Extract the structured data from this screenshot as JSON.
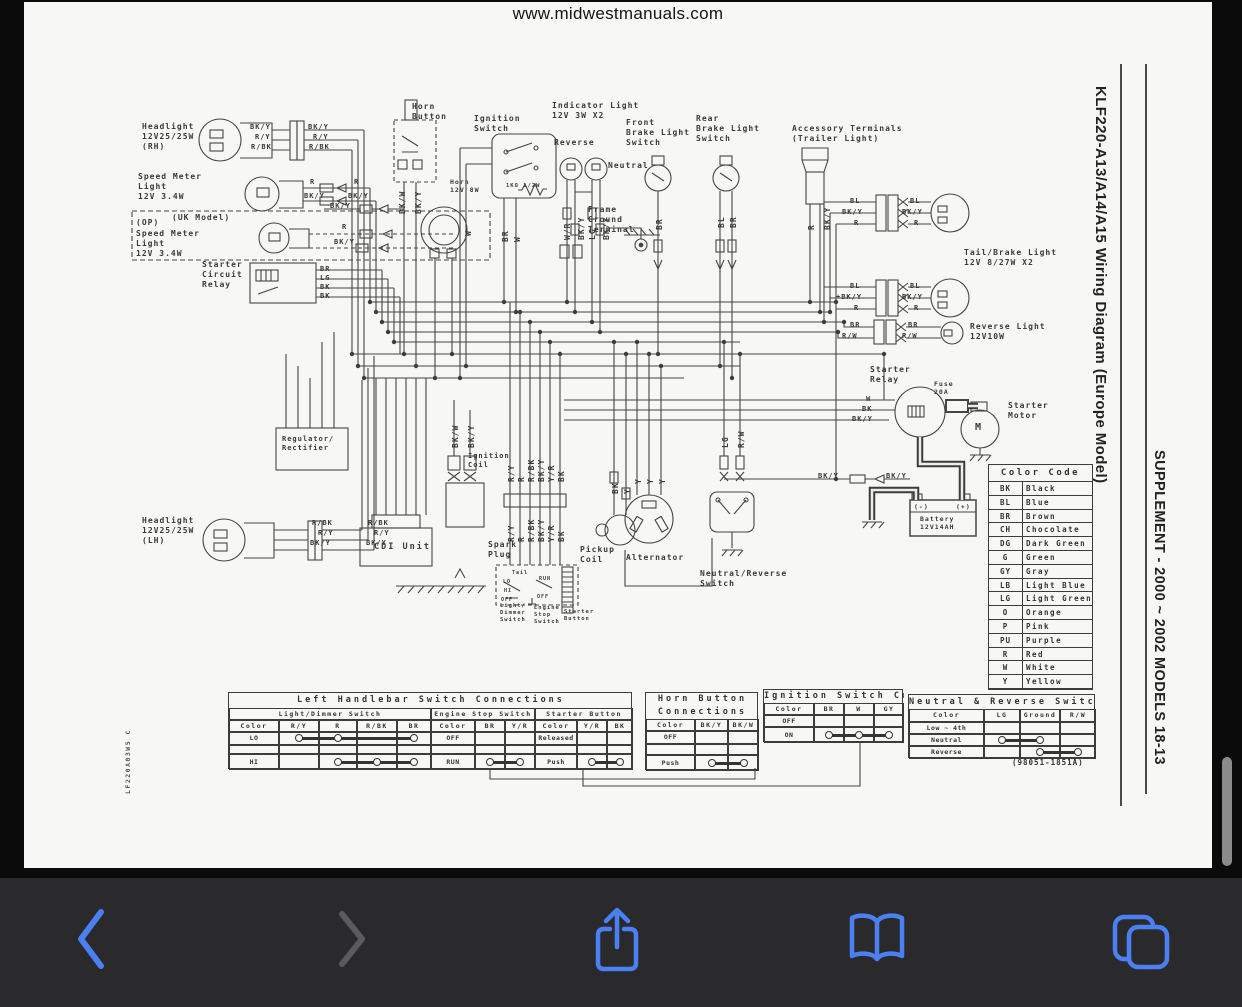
{
  "browser": {
    "url_header": "www.midwestmanuals.com",
    "toolbar": {
      "background": "#2a2a2c",
      "accent_blue": "#4b80f5",
      "disabled_gray": "#5b5b5f",
      "buttons": [
        {
          "name": "back",
          "enabled": true
        },
        {
          "name": "forward",
          "enabled": false
        },
        {
          "name": "share",
          "enabled": true
        },
        {
          "name": "bookmarks",
          "enabled": true
        },
        {
          "name": "tabs",
          "enabled": true
        }
      ]
    }
  },
  "page": {
    "side_title": "KLF220-A13/A14/A15 Wiring Diagram (Europe Model)",
    "side_subtitle": "SUPPLEMENT - 2000 ~ 2002 MODELS 18-13",
    "doc_code": "LF220A03W5 C",
    "part_number": "(98051-1851A)"
  },
  "color_code": {
    "title": "Color Code",
    "rows": [
      [
        "BK",
        "Black"
      ],
      [
        "BL",
        "Blue"
      ],
      [
        "BR",
        "Brown"
      ],
      [
        "CH",
        "Chocolate"
      ],
      [
        "DG",
        "Dark Green"
      ],
      [
        "G",
        "Green"
      ],
      [
        "GY",
        "Gray"
      ],
      [
        "LB",
        "Light Blue"
      ],
      [
        "LG",
        "Light Green"
      ],
      [
        "O",
        "Orange"
      ],
      [
        "P",
        "Pink"
      ],
      [
        "PU",
        "Purple"
      ],
      [
        "R",
        "Red"
      ],
      [
        "W",
        "White"
      ],
      [
        "Y",
        "Yellow"
      ]
    ]
  },
  "connection_tables": [
    {
      "x": 204,
      "y": 690,
      "w": 404,
      "title_lines": [
        "Left Handlebar Switch Connections"
      ],
      "title_h": 15,
      "sec_h": 12,
      "col_h": 12,
      "rows_h": [
        13,
        9,
        16
      ],
      "sections": [
        {
          "w": 202,
          "header": "Light/Dimmer Switch",
          "widths": [
            50,
            40,
            38,
            40,
            34
          ],
          "cols": [
            "Color",
            "R/Y",
            "R",
            "R/BK",
            "BR"
          ],
          "rows": [
            {
              "label": "LO",
              "conn": [
                1,
                2,
                4
              ]
            },
            {
              "label": ""
            },
            {
              "label": "HI",
              "conn": [
                2,
                3,
                4
              ]
            }
          ]
        },
        {
          "w": 104,
          "header": "Engine Stop Switch",
          "widths": [
            44,
            30,
            30
          ],
          "cols": [
            "Color",
            "BR",
            "Y/R"
          ],
          "rows": [
            {
              "label": "OFF"
            },
            {
              "label": ""
            },
            {
              "label": "RUN",
              "conn": [
                1,
                2
              ]
            }
          ]
        },
        {
          "w": 98,
          "header": "Starter Button",
          "widths": [
            42,
            30,
            26
          ],
          "cols": [
            "Color",
            "Y/R",
            "BK"
          ],
          "rows": [
            {
              "label": "Released"
            },
            {
              "label": ""
            },
            {
              "label": "Push",
              "conn": [
                1,
                2
              ]
            }
          ]
        }
      ]
    },
    {
      "x": 621,
      "y": 690,
      "w": 113,
      "title_lines": [
        "Horn Button",
        "Connections"
      ],
      "title_h": 26,
      "sec_h": 0,
      "col_h": 12,
      "rows_h": [
        13,
        11,
        16
      ],
      "sections": [
        {
          "w": 113,
          "header": null,
          "widths": [
            49,
            33,
            31
          ],
          "cols": [
            "Color",
            "BK/Y",
            "BK/W"
          ],
          "rows": [
            {
              "label": "OFF"
            },
            {
              "label": ""
            },
            {
              "label": "Push",
              "conn": [
                1,
                2
              ]
            }
          ]
        }
      ]
    },
    {
      "x": 739,
      "y": 687,
      "w": 140,
      "title_lines": [
        "Ignition Switch Connections"
      ],
      "title_h": 13,
      "sec_h": 0,
      "col_h": 12,
      "rows_h": [
        12,
        16
      ],
      "sections": [
        {
          "w": 140,
          "header": null,
          "widths": [
            50,
            30,
            30,
            30
          ],
          "cols": [
            "Color",
            "BR",
            "W",
            "GY"
          ],
          "rows": [
            {
              "label": "OFF"
            },
            {
              "label": "ON",
              "conn": [
                1,
                2,
                3
              ]
            }
          ]
        }
      ]
    },
    {
      "x": 884,
      "y": 692,
      "w": 187,
      "title_lines": [
        "Neutral & Reverse Switch Connections"
      ],
      "title_h": 14,
      "sec_h": 0,
      "col_h": 13,
      "rows_h": [
        12,
        12,
        13
      ],
      "sections": [
        {
          "w": 187,
          "header": null,
          "widths": [
            75,
            36,
            40,
            36
          ],
          "cols": [
            "Color",
            "LG",
            "Ground",
            "R/W"
          ],
          "rows": [
            {
              "label": "Low ~ 4th"
            },
            {
              "label": "Neutral",
              "conn": [
                1,
                2
              ]
            },
            {
              "label": "Reverse",
              "conn": [
                2,
                3
              ]
            }
          ]
        }
      ]
    }
  ],
  "diagram": {
    "labels": [
      {
        "x": 118,
        "y": 120,
        "t": "Headlight\n12V25/25W\n(RH)"
      },
      {
        "x": 226,
        "y": 121,
        "t": "BK/Y",
        "s": 7
      },
      {
        "x": 231,
        "y": 131,
        "t": "R/Y",
        "s": 7
      },
      {
        "x": 227,
        "y": 141,
        "t": "R/BK",
        "s": 7
      },
      {
        "x": 284,
        "y": 121,
        "t": "BK/Y",
        "s": 7
      },
      {
        "x": 289,
        "y": 131,
        "t": "R/Y",
        "s": 7
      },
      {
        "x": 285,
        "y": 141,
        "t": "R/BK",
        "s": 7
      },
      {
        "x": 114,
        "y": 170,
        "t": "Speed Meter\nLight\n12V 3.4W"
      },
      {
        "x": 286,
        "y": 176,
        "t": "R",
        "s": 7
      },
      {
        "x": 330,
        "y": 176,
        "t": "R",
        "s": 7
      },
      {
        "x": 280,
        "y": 190,
        "t": "BK/Y",
        "s": 7
      },
      {
        "x": 324,
        "y": 190,
        "t": "BK/Y",
        "s": 7
      },
      {
        "x": 306,
        "y": 200,
        "t": "BK/Y",
        "s": 7
      },
      {
        "x": 112,
        "y": 216,
        "t": "(OP)"
      },
      {
        "x": 148,
        "y": 211,
        "t": "(UK Model)"
      },
      {
        "x": 112,
        "y": 227,
        "t": "Speed Meter\nLight\n12V 3.4W"
      },
      {
        "x": 318,
        "y": 221,
        "t": "R",
        "s": 7
      },
      {
        "x": 310,
        "y": 236,
        "t": "BK/Y",
        "s": 7
      },
      {
        "x": 178,
        "y": 258,
        "t": "Starter\nCircuit\nRelay"
      },
      {
        "x": 296,
        "y": 263,
        "t": "BR",
        "s": 7
      },
      {
        "x": 296,
        "y": 272,
        "t": "LG",
        "s": 7
      },
      {
        "x": 296,
        "y": 281,
        "t": "BK",
        "s": 7
      },
      {
        "x": 296,
        "y": 290,
        "t": "BK",
        "s": 7
      },
      {
        "x": 388,
        "y": 100,
        "t": "Horn\nButton"
      },
      {
        "x": 450,
        "y": 112,
        "t": "Ignition\nSwitch"
      },
      {
        "x": 426,
        "y": 176,
        "t": "Horn\n12V 8W",
        "s": 6.5
      },
      {
        "x": 482,
        "y": 181,
        "t": "1KΩ 1/2W",
        "s": 5.5
      },
      {
        "x": 528,
        "y": 99,
        "t": "Indicator Light\n12V 3W X2"
      },
      {
        "x": 530,
        "y": 136,
        "t": "Reverse"
      },
      {
        "x": 584,
        "y": 159,
        "t": "Neutral"
      },
      {
        "x": 564,
        "y": 203,
        "t": "Frame\nGround\nTerminal"
      },
      {
        "x": 602,
        "y": 116,
        "t": "Front\nBrake Light\nSwitch"
      },
      {
        "x": 672,
        "y": 112,
        "t": "Rear\nBrake Light\nSwitch"
      },
      {
        "x": 768,
        "y": 122,
        "t": "Accessory Terminals\n(Trailer Light)"
      },
      {
        "x": 940,
        "y": 246,
        "t": "Tail/Brake Light\n12V 8/27W X2"
      },
      {
        "x": 826,
        "y": 195,
        "t": "BL",
        "s": 7
      },
      {
        "x": 818,
        "y": 206,
        "t": "BK/Y",
        "s": 7
      },
      {
        "x": 830,
        "y": 217,
        "t": "R",
        "s": 7
      },
      {
        "x": 886,
        "y": 195,
        "t": "BL",
        "s": 7
      },
      {
        "x": 878,
        "y": 206,
        "t": "BK/Y",
        "s": 7
      },
      {
        "x": 890,
        "y": 217,
        "t": "R",
        "s": 7
      },
      {
        "x": 826,
        "y": 280,
        "t": "BL",
        "s": 7
      },
      {
        "x": 812,
        "y": 291,
        "t": "+BK/Y",
        "s": 7
      },
      {
        "x": 830,
        "y": 302,
        "t": "R",
        "s": 7
      },
      {
        "x": 886,
        "y": 280,
        "t": "BL",
        "s": 7
      },
      {
        "x": 878,
        "y": 291,
        "t": "BK/Y",
        "s": 7
      },
      {
        "x": 890,
        "y": 302,
        "t": "R",
        "s": 7
      },
      {
        "x": 826,
        "y": 319,
        "t": "BR",
        "s": 7
      },
      {
        "x": 818,
        "y": 330,
        "t": "R/W",
        "s": 7
      },
      {
        "x": 884,
        "y": 319,
        "t": "BR",
        "s": 7
      },
      {
        "x": 878,
        "y": 330,
        "t": "R/W",
        "s": 7
      },
      {
        "x": 946,
        "y": 320,
        "t": "Reverse Light\n12V10W"
      },
      {
        "x": 846,
        "y": 363,
        "t": "Starter\nRelay"
      },
      {
        "x": 910,
        "y": 378,
        "t": "Fuse\n20A",
        "s": 6.5
      },
      {
        "x": 984,
        "y": 399,
        "t": "Starter\nMotor"
      },
      {
        "x": 842,
        "y": 393,
        "t": "W",
        "s": 7
      },
      {
        "x": 838,
        "y": 403,
        "t": "BK",
        "s": 7
      },
      {
        "x": 828,
        "y": 413,
        "t": "BK/Y",
        "s": 7
      },
      {
        "x": 794,
        "y": 470,
        "t": "BK/Y",
        "s": 7
      },
      {
        "x": 862,
        "y": 470,
        "t": "BK/Y",
        "s": 7
      },
      {
        "x": 890,
        "y": 501,
        "t": "(-)",
        "s": 6.5
      },
      {
        "x": 932,
        "y": 501,
        "t": "(+)",
        "s": 6.5
      },
      {
        "x": 896,
        "y": 513,
        "t": "Battery\n12V14AH",
        "s": 6.5
      },
      {
        "x": 258,
        "y": 433,
        "t": "Regulator/\nRectifier",
        "s": 7
      },
      {
        "x": 118,
        "y": 514,
        "t": "Headlight\n12V25/25W\n(LH)"
      },
      {
        "x": 288,
        "y": 517,
        "t": "R/BK",
        "s": 7
      },
      {
        "x": 294,
        "y": 527,
        "t": "R/Y",
        "s": 7
      },
      {
        "x": 286,
        "y": 537,
        "t": "BK/Y",
        "s": 7
      },
      {
        "x": 344,
        "y": 517,
        "t": "R/BK",
        "s": 7
      },
      {
        "x": 350,
        "y": 527,
        "t": "R/Y",
        "s": 7
      },
      {
        "x": 342,
        "y": 537,
        "t": "BK/Y",
        "s": 7
      },
      {
        "x": 350,
        "y": 540,
        "t": "CDI Unit",
        "s": 8.5,
        "ls": 2
      },
      {
        "x": 444,
        "y": 450,
        "t": "Ignition\nCoil",
        "s": 7
      },
      {
        "x": 464,
        "y": 538,
        "t": "Spark\nPlug"
      },
      {
        "x": 556,
        "y": 543,
        "t": "Pickup\nCoil"
      },
      {
        "x": 602,
        "y": 551,
        "t": "Alternator"
      },
      {
        "x": 676,
        "y": 567,
        "t": "Neutral/Reverse\nSwitch"
      },
      {
        "x": 476,
        "y": 601,
        "t": "Light/\nDimmer\nSwitch",
        "s": 5.5
      },
      {
        "x": 510,
        "y": 603,
        "t": "Engine\nStop\nSwitch",
        "s": 5.5
      },
      {
        "x": 540,
        "y": 607,
        "t": "Starter\nButton",
        "s": 5.5
      },
      {
        "x": 488,
        "y": 568,
        "t": "Tail",
        "s": 5
      },
      {
        "x": 479,
        "y": 577,
        "t": "LO",
        "s": 5
      },
      {
        "x": 480,
        "y": 586,
        "t": "HI",
        "s": 5
      },
      {
        "x": 477,
        "y": 595,
        "t": "OFF",
        "s": 5
      },
      {
        "x": 515,
        "y": 574,
        "t": "RUN",
        "s": 5
      },
      {
        "x": 513,
        "y": 592,
        "t": "OFF",
        "s": 5
      },
      {
        "x": 951,
        "y": 420,
        "t": "M",
        "s": 10
      },
      {
        "x": 374,
        "y": 212,
        "t": "BK/W",
        "r": 1
      },
      {
        "x": 390,
        "y": 212,
        "t": "BK/Y",
        "r": 1
      },
      {
        "x": 440,
        "y": 234,
        "t": "W",
        "r": 1
      },
      {
        "x": 477,
        "y": 240,
        "t": "BR",
        "r": 1
      },
      {
        "x": 489,
        "y": 240,
        "t": "W",
        "r": 1
      },
      {
        "x": 539,
        "y": 238,
        "t": "W/R",
        "r": 1
      },
      {
        "x": 553,
        "y": 238,
        "t": "BK/Y",
        "r": 1
      },
      {
        "x": 564,
        "y": 238,
        "t": "LG",
        "r": 1
      },
      {
        "x": 578,
        "y": 238,
        "t": "BK/Y",
        "r": 1
      },
      {
        "x": 631,
        "y": 228,
        "t": "BR",
        "r": 1
      },
      {
        "x": 693,
        "y": 226,
        "t": "BL",
        "r": 1
      },
      {
        "x": 705,
        "y": 226,
        "t": "BR",
        "r": 1
      },
      {
        "x": 783,
        "y": 228,
        "t": "R",
        "r": 1
      },
      {
        "x": 799,
        "y": 228,
        "t": "BK/Y",
        "r": 1
      },
      {
        "x": 483,
        "y": 480,
        "t": "R/Y",
        "r": 1
      },
      {
        "x": 493,
        "y": 480,
        "t": "R",
        "r": 1
      },
      {
        "x": 503,
        "y": 480,
        "t": "R/BK",
        "r": 1
      },
      {
        "x": 513,
        "y": 480,
        "t": "BK/Y",
        "r": 1
      },
      {
        "x": 523,
        "y": 480,
        "t": "Y/R",
        "r": 1
      },
      {
        "x": 533,
        "y": 480,
        "t": "BK",
        "r": 1
      },
      {
        "x": 483,
        "y": 540,
        "t": "R/Y",
        "r": 1
      },
      {
        "x": 493,
        "y": 540,
        "t": "R",
        "r": 1
      },
      {
        "x": 503,
        "y": 540,
        "t": "R/BK",
        "r": 1
      },
      {
        "x": 513,
        "y": 540,
        "t": "BK/Y",
        "r": 1
      },
      {
        "x": 523,
        "y": 540,
        "t": "Y/R",
        "r": 1
      },
      {
        "x": 533,
        "y": 540,
        "t": "BK",
        "r": 1
      },
      {
        "x": 427,
        "y": 446,
        "t": "BK/W",
        "r": 1
      },
      {
        "x": 443,
        "y": 446,
        "t": "BK/Y",
        "r": 1
      },
      {
        "x": 587,
        "y": 492,
        "t": "BK",
        "r": 1
      },
      {
        "x": 599,
        "y": 492,
        "t": "Y",
        "r": 1
      },
      {
        "x": 610,
        "y": 482,
        "t": "Y",
        "r": 1
      },
      {
        "x": 622,
        "y": 482,
        "t": "Y",
        "r": 1
      },
      {
        "x": 634,
        "y": 482,
        "t": "Y",
        "r": 1
      },
      {
        "x": 697,
        "y": 446,
        "t": "LG",
        "r": 1
      },
      {
        "x": 713,
        "y": 446,
        "t": "R/W",
        "r": 1
      }
    ]
  }
}
